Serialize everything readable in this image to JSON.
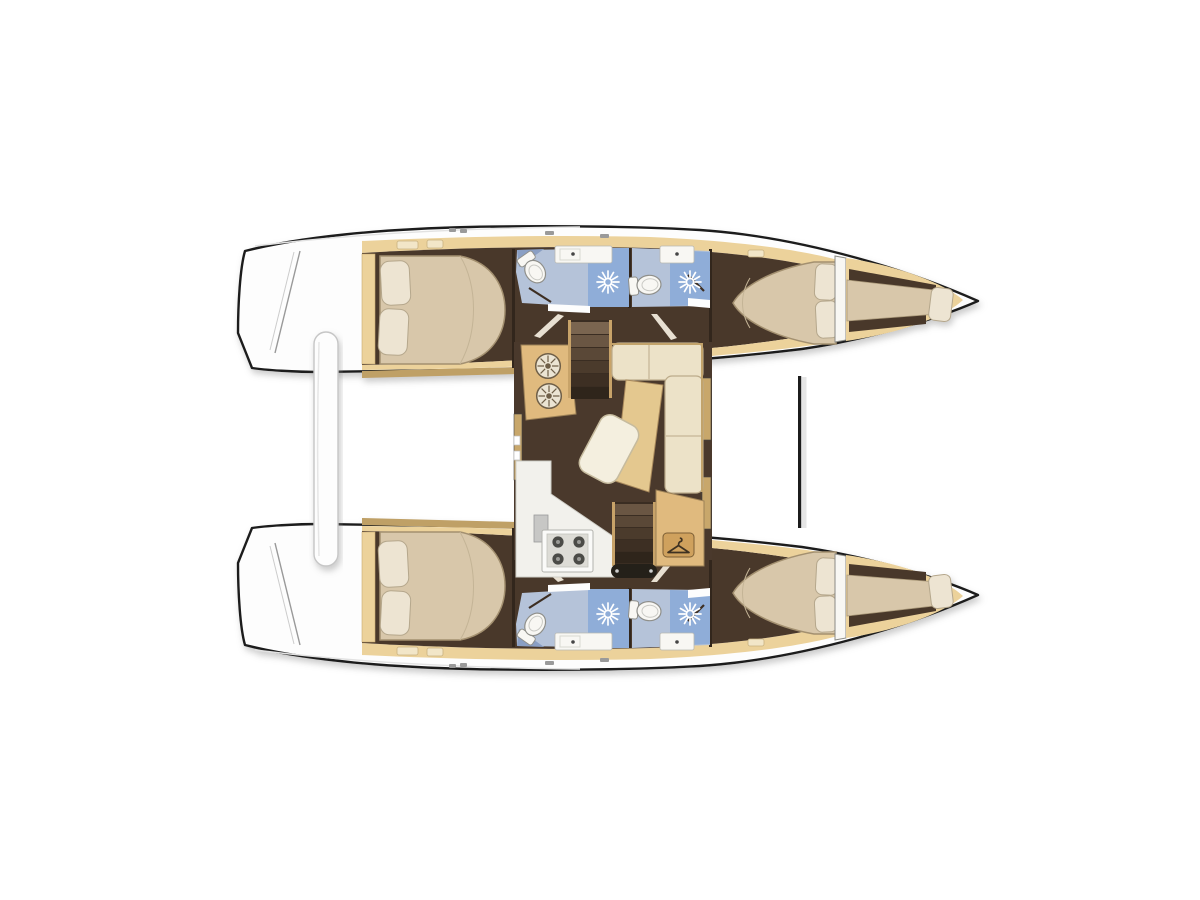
{
  "diagram": {
    "type": "catamaran-interior-floor-plan",
    "view": "top-down",
    "depicted": {
      "hulls": 2,
      "double_cabins": 4,
      "heads_with_shower": 4,
      "forepeak_berths": 2,
      "saloon_with_galley": 1,
      "stairs": 2,
      "wardrobe": 1
    }
  },
  "icons": {
    "shower": "sunburst-rays-icon",
    "toilet": "toilet-top-view-icon",
    "sink": "basin-counter-icon",
    "galley_sinks": "twin-round-sinks-icon",
    "stove": "four-burner-hob-icon",
    "wardrobe": "clothes-hanger-icon"
  },
  "palette": {
    "deck": "#fdfdfd",
    "outline": "#1d1d1d",
    "floor": "#4a392c",
    "wood": "#ecd29b",
    "woodDark": "#c8a76b",
    "coaming": "#bfa066",
    "bed": "#d8c7aa",
    "bedEdge": "#a3906f",
    "pillow": "#ede4d2",
    "pillowEdge": "#b5a78c",
    "bathFloor": "#b5c3d9",
    "bathWedge": "#8a9fc4",
    "shower": "#8fadd8",
    "fixture": "#f8f7f3",
    "sofa": "#ece2c8",
    "chaise": "#e4c88f",
    "table": "#f4efdf",
    "counter": "#e0ba7e",
    "counterEdge": "#9c8157",
    "plate": "#cfa15d",
    "stairs": "#3a2d22",
    "rail": "#c8a369",
    "treads": [
      "#7a6550",
      "#6a5643",
      "#5a4837",
      "#4b3b2c",
      "#3d2f23",
      "#2f251b"
    ],
    "threshold": "#242019",
    "beam": "#1c1c1c",
    "beamShadow": "#cfcfcf",
    "appliance": "#c7c7c5",
    "stoveFace": "#fafaf8",
    "stoveInner": "#dddcd6",
    "burner": "#4b4b47",
    "sun": "#ffffff",
    "wall": "#32281e",
    "doorSwing": "#3c2f24",
    "doorOpen": "#e8e0d2",
    "galley": "#f2f1ec",
    "sinkFace": "#ebe4d3",
    "spoke": "#6f5f48",
    "hanger": "#3f3222",
    "hatch": "#f2e6c8",
    "cleat": "#9a9a9a"
  }
}
